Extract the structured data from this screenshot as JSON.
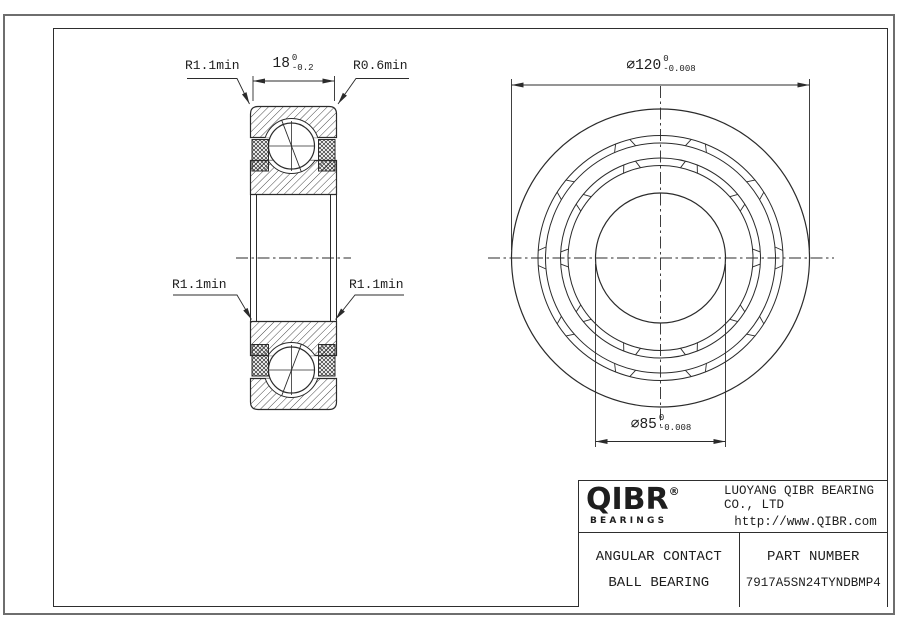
{
  "sheet": {
    "background": "#ffffff",
    "line_color": "#2b2b2b",
    "outer_border_color": "#6e6e6e"
  },
  "section_view": {
    "dim_width": {
      "value": "18",
      "tol_upper": "0",
      "tol_lower": "-0.2"
    },
    "radius_top_left": "R1.1min",
    "radius_top_right": "R0.6min",
    "radius_mid_left": "R1.1min",
    "radius_mid_right": "R1.1min"
  },
  "front_view": {
    "dim_outer_diameter": {
      "value": "∅120",
      "tol_upper": "0",
      "tol_lower": "-0.008"
    },
    "dim_bore_diameter": {
      "value": "∅85",
      "tol_upper": "0",
      "tol_lower": "-0.008"
    }
  },
  "title_block": {
    "brand": {
      "name": "QIBR",
      "registered": "®",
      "sub": "BEARINGS"
    },
    "company": "LUOYANG QIBR BEARING CO., LTD",
    "website": "http://www.QIBR.com",
    "product": {
      "line1": "ANGULAR CONTACT",
      "line2": "BALL BEARING"
    },
    "part_number_label": "PART NUMBER",
    "part_number": "7917A5SN24TYNDBMP4"
  }
}
